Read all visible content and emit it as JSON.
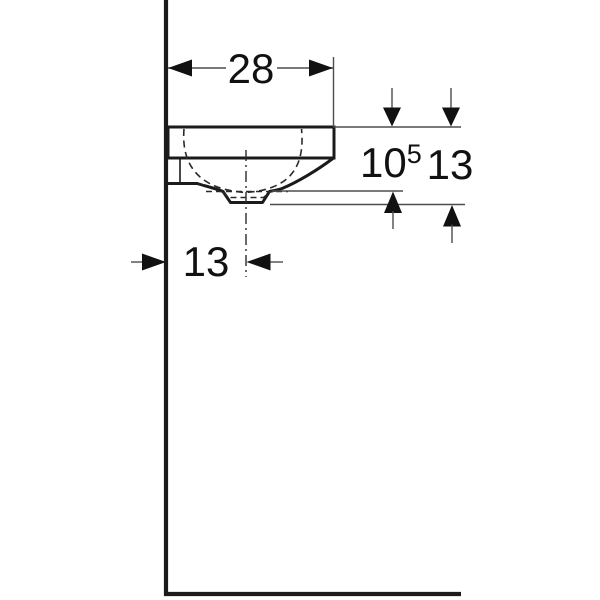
{
  "drawing": {
    "colors": {
      "outline": "#1b1b1b",
      "dimension_line": "#4d4d4d",
      "text": "#111111",
      "background": "#ffffff"
    },
    "dimensions": {
      "width_overall": {
        "label": "28"
      },
      "height_front": {
        "base": "10",
        "sup": "5"
      },
      "height_total": {
        "label": "13"
      },
      "drain_offset": {
        "label": "13"
      }
    }
  }
}
